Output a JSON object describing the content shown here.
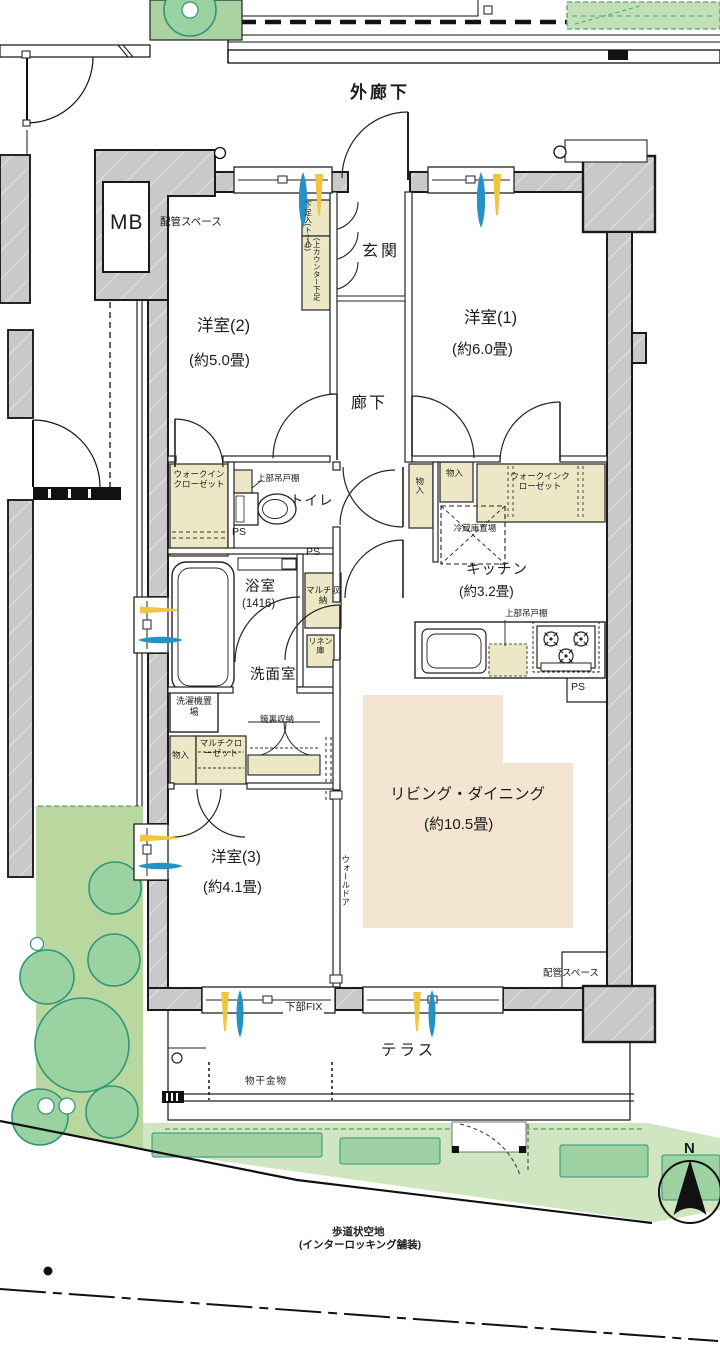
{
  "floorplan": {
    "site": {
      "outer_corridor": "外廊下",
      "walkway_line1": "歩道状空地",
      "walkway_line2": "(インターロッキング舗装)",
      "compass_north": "N"
    },
    "rooms": {
      "entrance": "玄関",
      "western1_name": "洋室(1)",
      "western1_size": "(約6.0畳)",
      "western2_name": "洋室(2)",
      "western2_size": "(約5.0畳)",
      "western3_name": "洋室(3)",
      "western3_size": "(約4.1畳)",
      "hallway": "廊下",
      "living_name": "リビング・ダイニング",
      "living_size": "(約10.5畳)",
      "kitchen_name": "キッチン",
      "kitchen_size": "(約3.2畳)",
      "bath_name": "浴室",
      "bath_size": "(1416)",
      "washroom": "洗面室",
      "toilet": "トイレ",
      "terrace": "テラス"
    },
    "storage": {
      "wic": "ウォークインクローゼット",
      "shoe_tall": "下足入(トール)",
      "shoe_counter": "(上カウンター下足入)",
      "upper_cabinet": "上部吊戸棚",
      "multi_storage": "マルチ収納",
      "linen": "リネン庫",
      "monoire": "物入",
      "multi_closet": "マルチクローゼット",
      "mirror_cabinet": "鏡裏収納",
      "washer_space": "洗濯機置場",
      "fridge_space": "冷蔵庫置場"
    },
    "equipment": {
      "mb": "MB",
      "pipe_space": "配管スペース",
      "ps": "PS",
      "wall_door": "ウォールドア",
      "lower_fix": "下部FIX",
      "drying_fixture": "物干金物"
    },
    "colors": {
      "wall_fill": "#c9c9c9",
      "storage_fill": "#ece8c6",
      "living_fill": "#f4e5d2",
      "garden_fill": "#b9d8a0",
      "tree_fill": "#9bd2a2",
      "tree_stroke": "#2f9678",
      "band_fill": "#cfe6c0",
      "band_dark": "#9fd2a2",
      "arrow_blue": "#2492c6",
      "arrow_yellow": "#eec63f"
    }
  }
}
